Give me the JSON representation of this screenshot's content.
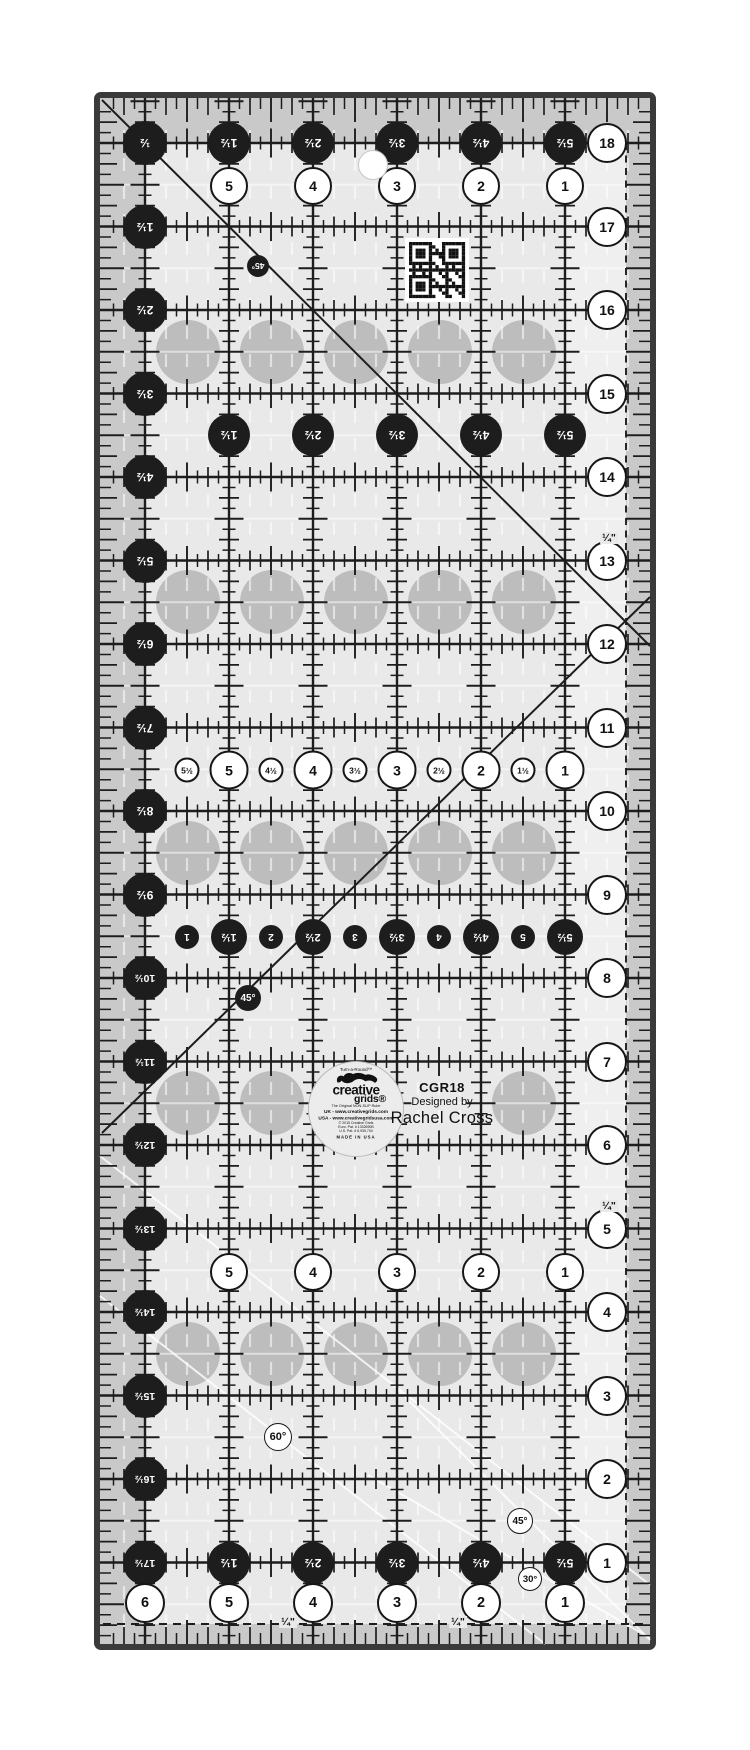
{
  "product": {
    "model": "CGR18",
    "designed_by": "Designed by",
    "designer": "Rachel Cross"
  },
  "logo": {
    "tagline": "Turn-a-Round™",
    "squirrel_icon": "leaping-squirrel",
    "brand_top": "creative",
    "brand_bottom": "grids®",
    "subtitle": "The Original NON-SLIP Ruler",
    "uk_line": "UK - www.creativegrids.com",
    "usa_line": "USA - www.creativegridsusa.com",
    "copyright": "© 2015 Creative Grids",
    "patent_1": "Euro. Pat. # 1332690B",
    "patent_2": "U.S. Pat. # 6,935,704",
    "made_in": "MADE IN USA"
  },
  "ruler": {
    "left_labels": [
      "½",
      "1½",
      "2½",
      "3½",
      "4½",
      "5½",
      "6½",
      "7½",
      "8½",
      "9½",
      "10½",
      "11½",
      "12½",
      "13½",
      "14½",
      "15½",
      "16½",
      "17½"
    ],
    "right_labels": [
      "18",
      "17",
      "16",
      "15",
      "14",
      "13",
      "12",
      "11",
      "10",
      "9",
      "8",
      "7",
      "6",
      "5",
      "4",
      "3",
      "2",
      "1"
    ],
    "top_black_extra": [
      "1½",
      "2½",
      "3½",
      "4½",
      "5½"
    ],
    "white_row_top": [
      "5",
      "4",
      "3",
      "2",
      "1"
    ],
    "black_row_2": [
      "1½",
      "2½",
      "3½",
      "4½",
      "5½"
    ],
    "white_row_mid": [
      "5½",
      "5",
      "4½",
      "4",
      "3½",
      "3",
      "2½",
      "2",
      "1½",
      "1"
    ],
    "black_row_3": [
      "1",
      "1½",
      "2",
      "2½",
      "3",
      "3½",
      "4",
      "4½",
      "5",
      "5½"
    ],
    "white_row_3": [
      "5",
      "4",
      "3",
      "2",
      "1"
    ],
    "black_row_bottom": [
      "1½",
      "2½",
      "3½",
      "4½",
      "5½"
    ],
    "white_row_bottom": [
      "6",
      "5",
      "4",
      "3",
      "2",
      "1"
    ],
    "angle_45_upper": "45°",
    "angle_45_mid": "45°",
    "angle_60": "60°",
    "angle_45_lower": "45°",
    "angle_30": "30°",
    "quarter_label": "¼\""
  },
  "colors": {
    "black": "#1d1d1d",
    "field": "#e9e9e9",
    "band": "#c9c9c9",
    "dot": "#bdbdbd",
    "edge": "#3a3a3a",
    "white": "#ffffff"
  }
}
